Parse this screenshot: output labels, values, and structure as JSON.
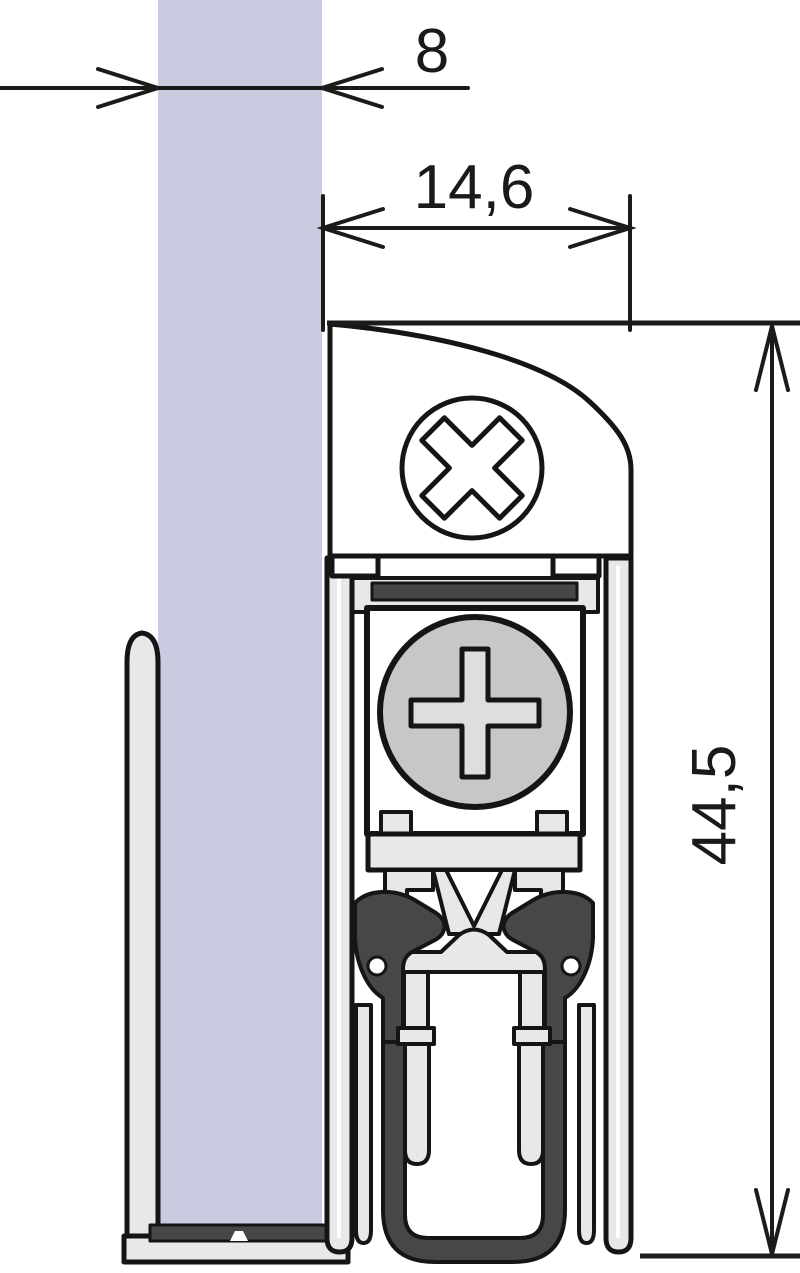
{
  "drawing": {
    "type": "technical-cross-section",
    "dimensions": {
      "glass_thickness": {
        "value": "8"
      },
      "seal_width": {
        "value": "14,6"
      },
      "seal_height": {
        "value": "44,5"
      }
    },
    "colors": {
      "glass": "#c9cce1",
      "aluminum": "#e8e8e8",
      "screw_head": "#c7c7c9",
      "screw_recess": "#dedede",
      "rubber": "#47474a",
      "line": "#151515",
      "background": "#ffffff"
    }
  }
}
